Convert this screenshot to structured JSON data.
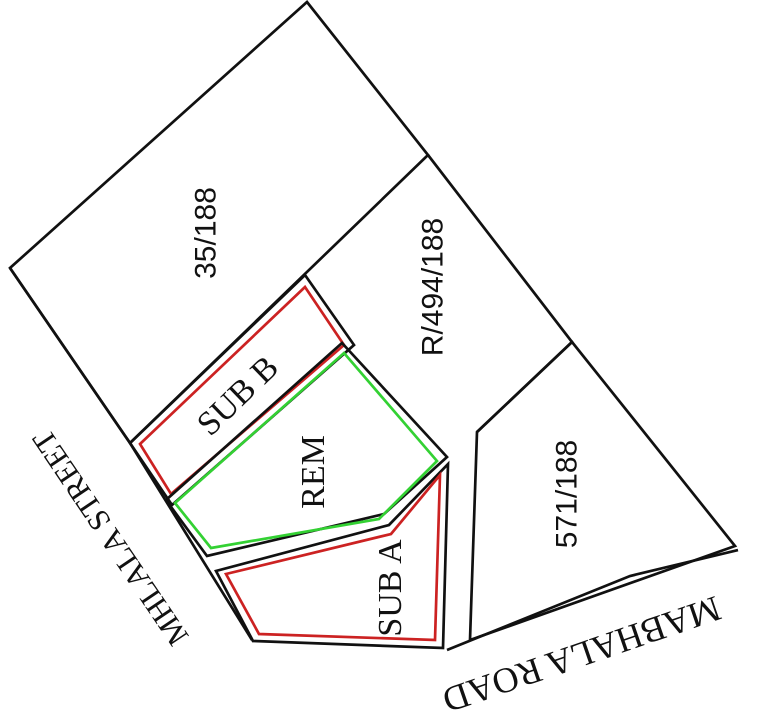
{
  "diagram": {
    "title": "cadastral subdivision diagram",
    "parcels": {
      "p35": {
        "label": "35/188"
      },
      "r494": {
        "label": "R/494/188"
      },
      "p571": {
        "label": "571/188"
      },
      "sub_b": {
        "label": "SUB B"
      },
      "rem": {
        "label": "REM"
      },
      "sub_a": {
        "label": "SUB A"
      }
    },
    "streets": {
      "mhlala": {
        "label": "MHLALA STREET"
      },
      "mabhala": {
        "label": "MABHALA ROAD"
      }
    },
    "colors": {
      "outline": "#111111",
      "highlight_red": "#cc2222",
      "highlight_green": "#33d133",
      "background": "#ffffff"
    }
  }
}
